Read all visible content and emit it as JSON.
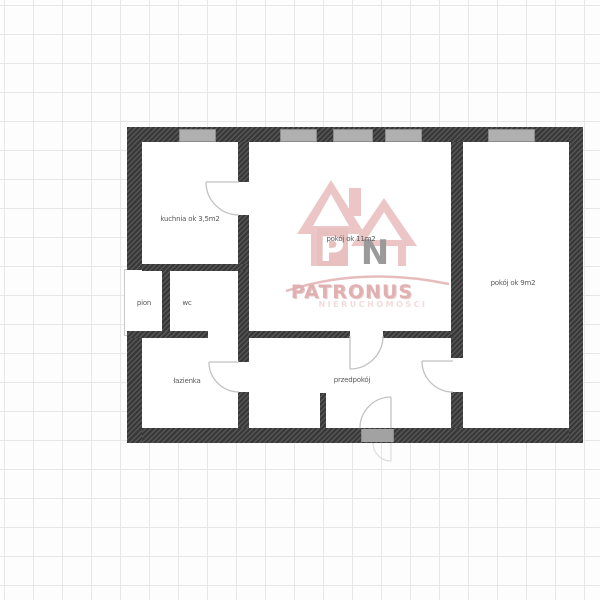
{
  "floorplan": {
    "rooms": [
      {
        "id": "kuchnia",
        "label": "kuchnia ok 3,5m2"
      },
      {
        "id": "pokoj-11",
        "label": "pokój ok 11m2"
      },
      {
        "id": "pokoj-9",
        "label": "pokój ok 9m2"
      },
      {
        "id": "pion",
        "label": "pion"
      },
      {
        "id": "wc",
        "label": "wc"
      },
      {
        "id": "lazienka",
        "label": "łazienka"
      },
      {
        "id": "przedpokoj",
        "label": "przedpokój"
      }
    ],
    "window_count": 5,
    "door_count": 5,
    "colors": {
      "wall": "#3d3d3d",
      "wall_hatch": "#565656",
      "window": "#b0b0b0",
      "door_arc": "#c2c2c2",
      "label_text": "#5a5a5a",
      "grid_line": "#e7e7e7"
    }
  },
  "watermark": {
    "monogram_p": "P",
    "monogram_n": "N",
    "name": "PATRONUS",
    "subtitle": "NIERUCHOMOŚCI",
    "accent": "#d08282"
  }
}
